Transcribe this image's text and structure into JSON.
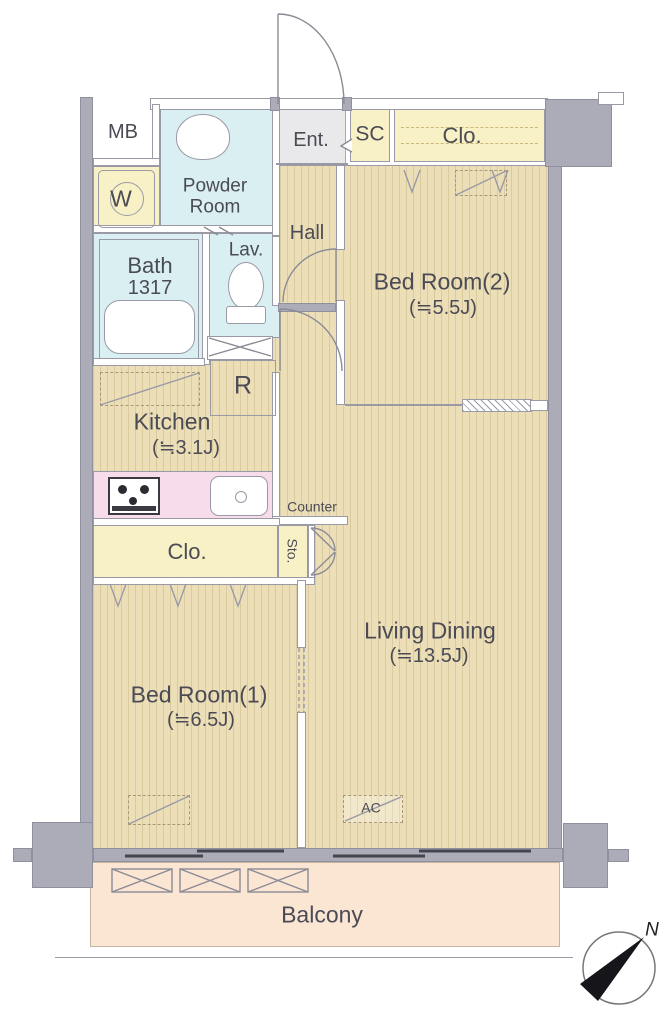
{
  "rooms": {
    "mb": {
      "label": "MB"
    },
    "powder_room": {
      "label": "Powder Room"
    },
    "washer": {
      "label": "W"
    },
    "entrance": {
      "label": "Ent."
    },
    "shoe_closet": {
      "label": "SC"
    },
    "closet_top": {
      "label": "Clo."
    },
    "bedroom2": {
      "label": "Bed Room(2)",
      "size": "(≒5.5J)"
    },
    "hall": {
      "label": "Hall"
    },
    "lavatory": {
      "label": "Lav."
    },
    "bath": {
      "label": "Bath",
      "size": "1317"
    },
    "fridge": {
      "label": "R"
    },
    "kitchen": {
      "label": "Kitchen",
      "size": "(≒3.1J)"
    },
    "counter": {
      "label": "Counter"
    },
    "closet_mid": {
      "label": "Clo."
    },
    "storage": {
      "label": "Sto."
    },
    "living_dining": {
      "label": "Living Dining",
      "size": "(≒13.5J)"
    },
    "bedroom1": {
      "label": "Bed Room(1)",
      "size": "(≒6.5J)"
    },
    "ac": {
      "label": "AC"
    },
    "balcony": {
      "label": "Balcony"
    }
  },
  "compass": {
    "north_label": "N"
  },
  "colors": {
    "floor": "#ECDFB8",
    "wet_area": "#D9EFF2",
    "closet": "#F8F1C6",
    "kitchen_counter": "#F7DCEB",
    "balcony": "#FBE6D3",
    "wall": "#ACACB9",
    "text": "#4B4B55"
  }
}
